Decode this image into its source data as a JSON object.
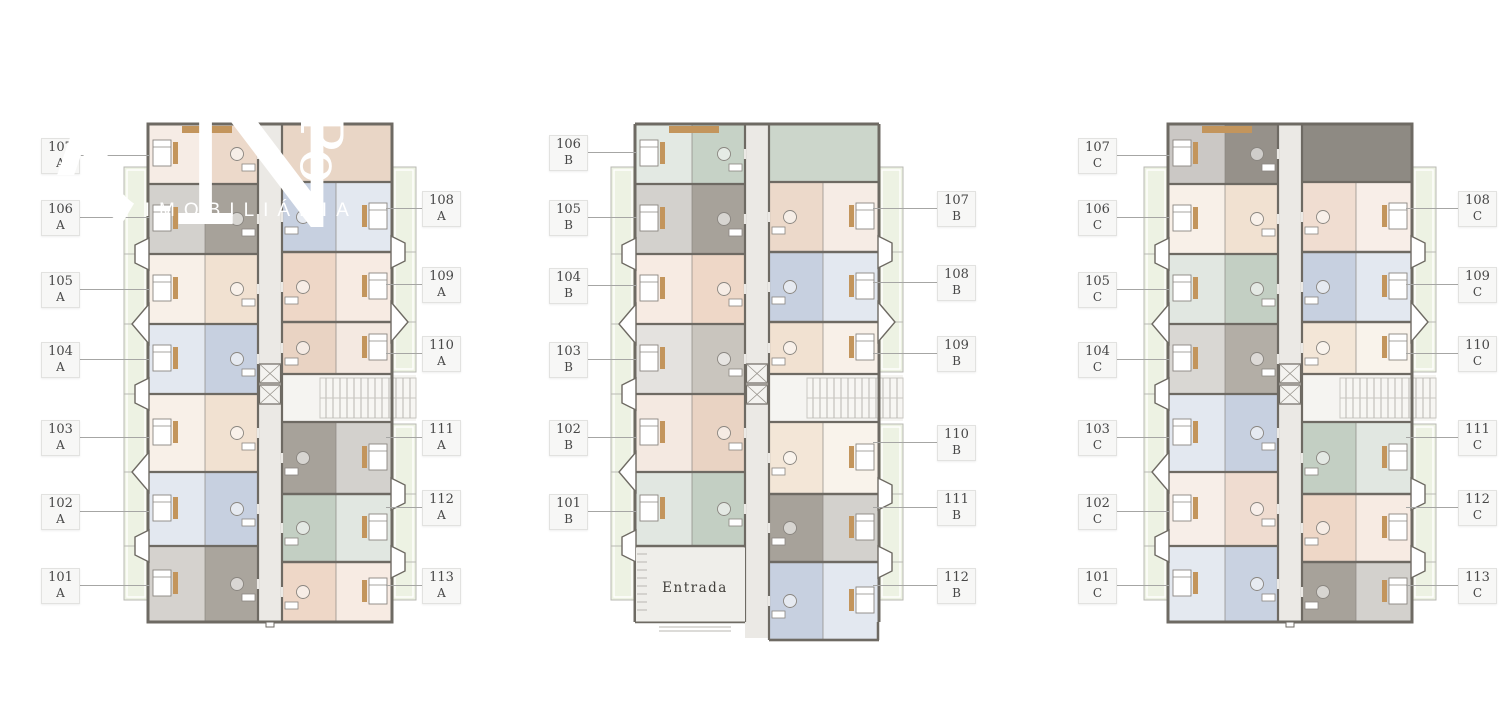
{
  "watermark": {
    "big_letter": "N",
    "vertical_text": "Po",
    "tagline": "ÃO IMOBILIÁRIA"
  },
  "palette": {
    "wall": "#6e6a63",
    "body_base": "#efe9e1",
    "corridor": "#ebe9e5",
    "balcony": "#edf2e3",
    "balcony_frame": "#b9b9b3",
    "stairs_bg": "#f5f4f1",
    "stair_line": "#b9b7b2",
    "wood": "#c3955c",
    "furniture": "#8a8680",
    "label_text": "#474747",
    "leader": "#a6a6a4",
    "entrada_floor": "#efeeea",
    "entrada_text": "#3f3d39"
  },
  "buildings": [
    {
      "id": "A",
      "x": 120,
      "y": 122,
      "label_x_left": 41,
      "label_x_right": 422,
      "top_right_color": "#e9d6c6",
      "entrance": null,
      "left_units": [
        {
          "num": "107",
          "label_y": 138,
          "color": "#ecd9ca"
        },
        {
          "num": "106",
          "label_y": 200,
          "color": "#a7a29a"
        },
        {
          "num": "105",
          "label_y": 272,
          "color": "#f1e1d1"
        },
        {
          "num": "104",
          "label_y": 342,
          "color": "#c7d0e0"
        },
        {
          "num": "103",
          "label_y": 420,
          "color": "#f1e1d1"
        },
        {
          "num": "102",
          "label_y": 494,
          "color": "#c7d0e0"
        },
        {
          "num": "101",
          "label_y": 568,
          "color": "#aaa59d"
        }
      ],
      "right_units": [
        {
          "num": "108",
          "label_y": 191,
          "color": "#c7d0e0"
        },
        {
          "num": "109",
          "label_y": 267,
          "color": "#eed7c7"
        },
        {
          "num": "110",
          "label_y": 336,
          "color": "#e9d3c3"
        },
        {
          "num": "111",
          "label_y": 420,
          "color": "#a7a29a"
        },
        {
          "num": "112",
          "label_y": 490,
          "color": "#c3cfc3"
        },
        {
          "num": "113",
          "label_y": 568,
          "color": "#eed7c7"
        }
      ]
    },
    {
      "id": "B",
      "x": 607,
      "y": 122,
      "label_x_left": 549,
      "label_x_right": 937,
      "top_right_color": "#ccd6cb",
      "entrance": {
        "label": "Entrada"
      },
      "left_units": [
        {
          "num": "106",
          "label_y": 135,
          "color": "#c6d2c6"
        },
        {
          "num": "105",
          "label_y": 200,
          "color": "#a7a29a"
        },
        {
          "num": "104",
          "label_y": 268,
          "color": "#eed7c7"
        },
        {
          "num": "103",
          "label_y": 342,
          "color": "#c9c5be"
        },
        {
          "num": "102",
          "label_y": 420,
          "color": "#e9d3c3"
        },
        {
          "num": "101",
          "label_y": 494,
          "color": "#c3cfc3"
        }
      ],
      "right_units": [
        {
          "num": "107",
          "label_y": 191,
          "color": "#ecd9ca"
        },
        {
          "num": "108",
          "label_y": 265,
          "color": "#c7d0e0"
        },
        {
          "num": "109",
          "label_y": 336,
          "color": "#f1e1d1"
        },
        {
          "num": "110",
          "label_y": 425,
          "color": "#f3e6d7"
        },
        {
          "num": "111",
          "label_y": 490,
          "color": "#a7a29a"
        },
        {
          "num": "112",
          "label_y": 568,
          "color": "#c7d0e0"
        }
      ]
    },
    {
      "id": "C",
      "x": 1140,
      "y": 122,
      "label_x_left": 1078,
      "label_x_right": 1458,
      "top_right_color": "#8e8a83",
      "entrance": null,
      "left_units": [
        {
          "num": "107",
          "label_y": 138,
          "color": "#96918a"
        },
        {
          "num": "106",
          "label_y": 200,
          "color": "#f1e1d1"
        },
        {
          "num": "105",
          "label_y": 272,
          "color": "#c3cfc3"
        },
        {
          "num": "104",
          "label_y": 342,
          "color": "#b3aea6"
        },
        {
          "num": "103",
          "label_y": 420,
          "color": "#c7d0e0"
        },
        {
          "num": "102",
          "label_y": 494,
          "color": "#efdcd0"
        },
        {
          "num": "101",
          "label_y": 568,
          "color": "#c9d2e1"
        }
      ],
      "right_units": [
        {
          "num": "108",
          "label_y": 191,
          "color": "#f0ddd1"
        },
        {
          "num": "109",
          "label_y": 267,
          "color": "#c7d0e0"
        },
        {
          "num": "110",
          "label_y": 336,
          "color": "#f3e6d7"
        },
        {
          "num": "111",
          "label_y": 420,
          "color": "#c3cfc3"
        },
        {
          "num": "112",
          "label_y": 490,
          "color": "#eed7c7"
        },
        {
          "num": "113",
          "label_y": 568,
          "color": "#a7a29a"
        }
      ]
    }
  ]
}
